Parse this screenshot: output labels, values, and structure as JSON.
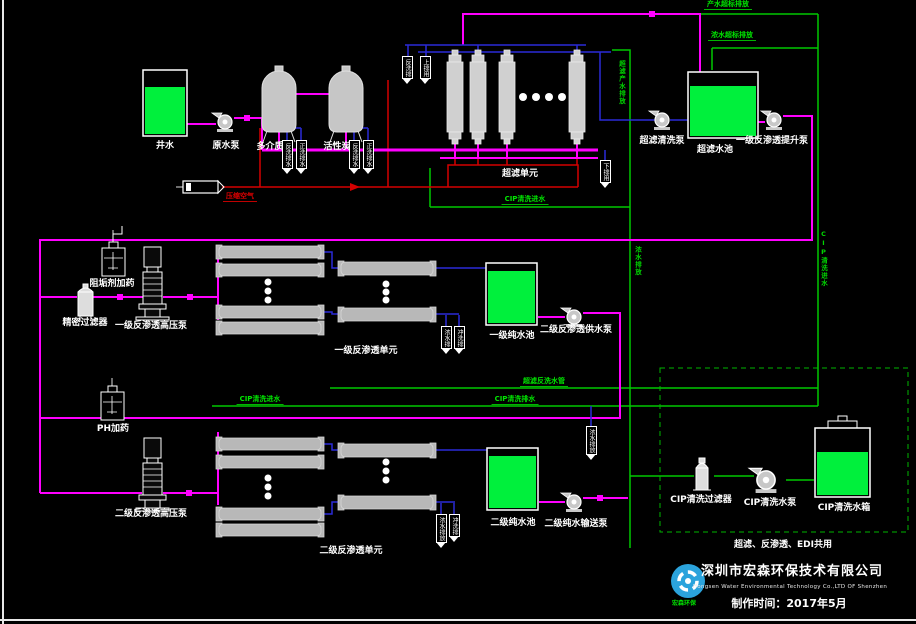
{
  "pretreatment": {
    "raw_tank_label": "井水",
    "raw_pump_label": "原水泵",
    "multimedia_filter_label": "多介质",
    "carbon_filter_label": "活性炭",
    "compressed_air_label": "压缩空气",
    "mm_tag_1": "反洗排水",
    "mm_tag_2": "正洗排水",
    "ac_tag_1": "反洗排水",
    "ac_tag_2": "正洗排水"
  },
  "uf": {
    "unit_label": "超滤单元",
    "tag_left_1": "反洗排",
    "tag_left_2": "上排用",
    "tag_right": "下排用",
    "clean_pump_label": "超滤清洗泵",
    "tank_label": "超滤水池",
    "lift_pump_label": "一级反渗透提升泵"
  },
  "ro1": {
    "antiscalant_label": "阻垢剂加药",
    "precision_filter_label": "精密过滤器",
    "hp_pump_label": "一级反渗透高压泵",
    "unit_label": "一级反渗透单元",
    "tag_1": "浓水排",
    "tag_2": "冲洗排",
    "tank_label": "一级纯水池",
    "feed_pump_label": "二级反渗透供水泵"
  },
  "ro2": {
    "ph_dosing_label": "PH加药",
    "hp_pump_label": "二级反渗透高压泵",
    "unit_label": "二级反渗透单元",
    "tag_1": "浓水排放",
    "tag_2": "冲洗排",
    "tank_tag": "浓水排放",
    "tank_label": "二级纯水池",
    "transfer_pump_label": "二级纯水输送泵"
  },
  "cip": {
    "filter_label": "CIP清洗过滤器",
    "pump_label": "CIP清洗水泵",
    "tank_label": "CIP清洗水箱",
    "shared_note": "超滤、反渗透、EDI共用"
  },
  "pipe_labels": {
    "product_overflow": "产水超标排放",
    "concentrate_overflow": "浓水超标排放",
    "cip_feed_uf": "CIP清洗进水",
    "uf_backwash": "超滤反洗水管",
    "cip_feed_ro": "CIP清洗进水",
    "cip_drain_ro": "CIP清洗排水",
    "v_uf_product": "超滤产水排放",
    "v_concentrate": "浓水排放",
    "v_cip_right": "CIP清洗进水"
  },
  "footer": {
    "logo_text": "宏森环保",
    "company_cn": "深圳市宏森环保技术有限公司",
    "company_en": "Hongsen Water Environmental Technology Co.,LTD OF Shenzhen",
    "made_date": "制作时间：2017年5月"
  },
  "colors": {
    "background": "#000000",
    "tank_fill": "#00f03c",
    "pipe_magenta": "#ff00ff",
    "pipe_blue": "#2a2ad8",
    "pipe_red": "#d40000",
    "pipe_green": "#00c800",
    "logo_blue": "#2ba3dc"
  }
}
